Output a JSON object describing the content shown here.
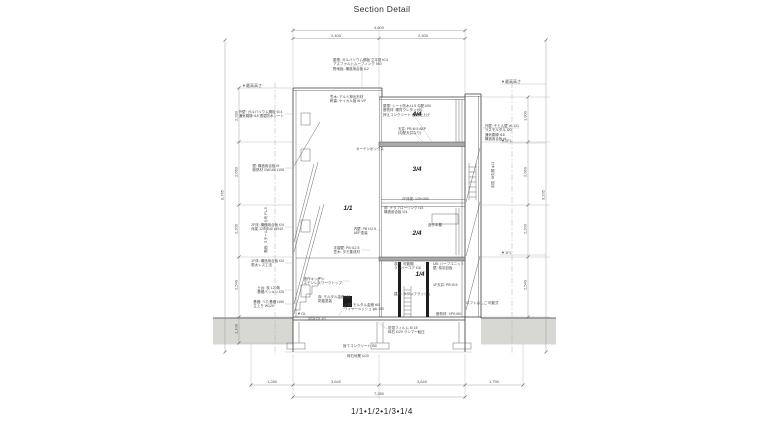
{
  "title": "Section Detail",
  "caption": "1/1•1/2•1/3•1/4",
  "colors": {
    "ground": "#d7d7d4",
    "slab": "#a9a9a6",
    "line": "#3a3a3a"
  },
  "rooms": [
    {
      "label": "1/1",
      "x": 348,
      "y": 209
    },
    {
      "label": "4/4",
      "x": 417,
      "y": 115
    },
    {
      "label": "3/4",
      "x": 417,
      "y": 170
    },
    {
      "label": "2/4",
      "x": 417,
      "y": 234
    },
    {
      "label": "1/4",
      "x": 420,
      "y": 275
    }
  ],
  "dims": [
    {
      "text": "4,800",
      "x": 379,
      "y": 25,
      "align": "c"
    },
    {
      "text": "2,400",
      "x": 336,
      "y": 33,
      "align": "c"
    },
    {
      "text": "2,400",
      "x": 423,
      "y": 33,
      "align": "c"
    },
    {
      "text": "1,280",
      "x": 272,
      "y": 379,
      "align": "c"
    },
    {
      "text": "3,640",
      "x": 336,
      "y": 379,
      "align": "c"
    },
    {
      "text": "3,640",
      "x": 422,
      "y": 379,
      "align": "c"
    },
    {
      "text": "1,790",
      "x": 494,
      "y": 379,
      "align": "c"
    },
    {
      "text": "7,280",
      "x": 379,
      "y": 391,
      "align": "c"
    },
    {
      "text": "8,765",
      "x": 222,
      "y": 195,
      "rot": true
    },
    {
      "text": "2,280",
      "x": 236,
      "y": 116,
      "rot": true
    },
    {
      "text": "2,660",
      "x": 236,
      "y": 172,
      "rot": true
    },
    {
      "text": "2,200",
      "x": 236,
      "y": 229,
      "rot": true
    },
    {
      "text": "2,540",
      "x": 236,
      "y": 285,
      "rot": true
    },
    {
      "text": "1,100",
      "x": 236,
      "y": 329,
      "rot": true
    },
    {
      "text": "1,900",
      "x": 525,
      "y": 116,
      "rot": true
    },
    {
      "text": "2,660",
      "x": 525,
      "y": 172,
      "rot": true
    },
    {
      "text": "2,200",
      "x": 525,
      "y": 229,
      "rot": true
    },
    {
      "text": "2,540",
      "x": 525,
      "y": 285,
      "rot": true
    },
    {
      "text": "9,165",
      "x": 543,
      "y": 195,
      "rot": true
    },
    {
      "text": "▼最高高さ",
      "x": 501,
      "y": 79,
      "align": "l"
    },
    {
      "text": "▼2FL",
      "x": 501,
      "y": 138,
      "align": "l"
    },
    {
      "text": "▼1FL",
      "x": 501,
      "y": 250,
      "align": "l"
    },
    {
      "text": "▼最高高さ",
      "x": 262,
      "y": 83,
      "align": "r"
    },
    {
      "text": "▼GL",
      "x": 297,
      "y": 311,
      "align": "l"
    },
    {
      "text": "設計GL±0",
      "x": 308,
      "y": 316,
      "align": "l"
    }
  ],
  "notes": [
    {
      "text": "外壁: ガルバリウム鋼板 t0.4\n通気胴縁 t18 透湿防水シート",
      "x": 284,
      "y": 110,
      "align": "r"
    },
    {
      "text": "壁: 構造用合板 t9\n断熱材 GW16K t105",
      "x": 284,
      "y": 164,
      "align": "r"
    },
    {
      "text": "2F床: 構造用合板 t24\n床梁 120×240 @910",
      "x": 284,
      "y": 223,
      "align": "r"
    },
    {
      "text": "1F床: 構造用合板 t24\n根太レス工法",
      "x": 284,
      "y": 259,
      "align": "r"
    },
    {
      "text": "土台: 桧 120角\n基礎パッキン t20",
      "x": 284,
      "y": 286,
      "align": "r"
    },
    {
      "text": "基礎: べた基礎 t150\n立上り W120",
      "x": 284,
      "y": 300,
      "align": "r"
    },
    {
      "text": "階段: スチールささら桁 PL-9",
      "x": 266,
      "y": 230,
      "rot": true
    },
    {
      "text": "屋根: ガルバリウム鋼板 立平葺 t0.4\nアスファルトルーフィング 940\n野地板: 構造用合板 t12",
      "x": 333,
      "y": 58,
      "align": "l"
    },
    {
      "text": "笠木: アルミ押出形材\n軒裏: ケイカル板 t6 VP",
      "x": 330,
      "y": 95,
      "align": "l"
    },
    {
      "text": "屋根: シート防水 t1.5 勾配1/50\n断熱材: 硬質ウレタン t50\n押えコンクリート 金鏝仕上げ",
      "x": 383,
      "y": 104,
      "align": "l"
    },
    {
      "text": "天井: PB t9.5 AEP\n(勾配天井なり)",
      "x": 398,
      "y": 127,
      "align": "l"
    },
    {
      "text": "カーテンボックス",
      "x": 356,
      "y": 147,
      "align": "l"
    },
    {
      "text": "内壁: PB t12.5\nAEP塗装",
      "x": 376,
      "y": 227,
      "align": "r"
    },
    {
      "text": "手摺壁: PB t12.5\n笠木: タモ集成材",
      "x": 360,
      "y": 246,
      "align": "r"
    },
    {
      "text": "造作キッチン\nステンレスワークトップ",
      "x": 342,
      "y": 277,
      "align": "r"
    },
    {
      "text": "床: モルタル金鏝 t30\n防塵塗装",
      "x": 318,
      "y": 295,
      "align": "l"
    },
    {
      "text": "2F床梁: 120×300",
      "x": 402,
      "y": 197,
      "align": "l"
    },
    {
      "text": "床: ナラフローリング t15\n構造用合板 t24",
      "x": 384,
      "y": 206,
      "align": "l"
    },
    {
      "text": "造作本棚",
      "x": 428,
      "y": 223,
      "align": "l"
    },
    {
      "text": "収納: 可動棚\nランバーコア t18",
      "x": 394,
      "y": 262,
      "align": "l"
    },
    {
      "text": "UB: ハーフユニット\n壁: 桧羽目板",
      "x": 433,
      "y": 262,
      "align": "l"
    },
    {
      "text": "1F天井: PB t9.5",
      "x": 433,
      "y": 283,
      "align": "l"
    },
    {
      "text": "建具: ラワンフラッシュ",
      "x": 394,
      "y": 292,
      "align": "l"
    },
    {
      "text": "ロフトはしご 可動式",
      "x": 466,
      "y": 301,
      "align": "l"
    },
    {
      "text": "断熱材: XPS t50",
      "x": 436,
      "y": 312,
      "align": "l"
    },
    {
      "text": "外壁: そとん壁 W-121\nラスモルタル t20\n通気胴縁 t18\n構造用合板 t9",
      "x": 519,
      "y": 124,
      "align": "r"
    },
    {
      "text": "手摺: St丸鋼 φ13",
      "x": 493,
      "y": 175,
      "rot": true
    },
    {
      "text": "土間: モルタル金鏝 t60\nワイヤーメッシュ φ6-150",
      "x": 344,
      "y": 303,
      "align": "l"
    },
    {
      "text": "防湿フィルム t0.15\n砕石 t120 ランマー転圧",
      "x": 388,
      "y": 326,
      "align": "l"
    },
    {
      "text": "捨てコンクリート t50",
      "x": 343,
      "y": 344,
      "align": "l"
    },
    {
      "text": "砕石地業 t120",
      "x": 347,
      "y": 354,
      "align": "l"
    }
  ]
}
